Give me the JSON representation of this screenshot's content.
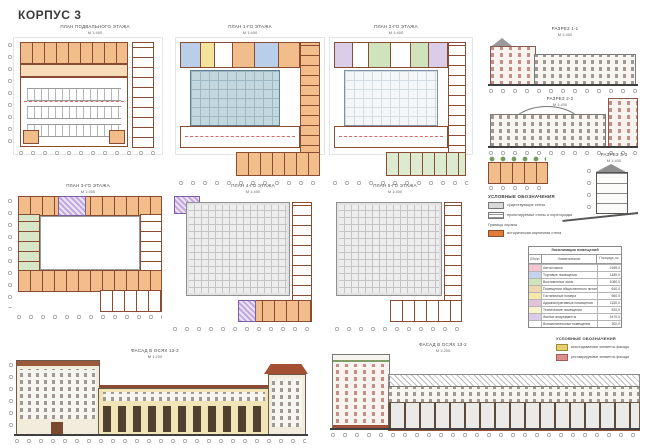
{
  "sheet_title": "КОРПУС 3",
  "plans": [
    {
      "title": "ПЛАН ПОДВАЛЬНОГО ЭТАЖА",
      "scale": "М 1:400"
    },
    {
      "title": "ПЛАН 1-ГО ЭТАЖА",
      "scale": "М 1:400"
    },
    {
      "title": "ПЛАН 2-ГО ЭТАЖА",
      "scale": "М 1:400"
    },
    {
      "title": "ПЛАН 3-ГО ЭТАЖА",
      "scale": "М 1:400"
    },
    {
      "title": "ПЛАН 4-ГО ЭТАЖА",
      "scale": "М 1:400"
    },
    {
      "title": "ПЛАН 5-ГО ЭТАЖА",
      "scale": "М 1:400"
    }
  ],
  "sections": [
    {
      "title": "РАЗРЕЗ 1-1",
      "scale": "М 1:400"
    },
    {
      "title": "РАЗРЕЗ 2-2",
      "scale": "М 1:400"
    },
    {
      "title": "РАЗРЕЗ 3-3",
      "scale": "М 1:400"
    }
  ],
  "facades": [
    {
      "title": "ФАСАД В ОСЯХ 13-2",
      "scale": "М 1:200"
    },
    {
      "title": "ФАСАД В ОСЯХ 13-2",
      "scale": "М 1:200"
    }
  ],
  "legend_sections": {
    "title": "УСЛОВНЫЕ ОБОЗНАЧЕНИЯ",
    "items": [
      {
        "label": "существующие стены"
      },
      {
        "label": "проектируемые стены и перегородки"
      }
    ],
    "subheading": "Границы охраны",
    "highlight_label": "историческая кирпичная стена"
  },
  "legend_facades": {
    "title": "УСЛОВНЫЕ ОБОЗНАЧЕНИЯ",
    "items": [
      {
        "label": "воссоздаваемые элементы фасада"
      },
      {
        "label": "реставрируемые элементы фасада"
      }
    ]
  },
  "room_table": {
    "title": "Экспликация помещений",
    "columns": [
      "Обозн.",
      "Наименование",
      "Площадь, м²"
    ],
    "rows": [
      {
        "color": "#f3c6d0",
        "name": "Автостоянка",
        "area": "2185,0"
      },
      {
        "color": "#c3d4ec",
        "name": "Торговые помещения",
        "area": "1180,0"
      },
      {
        "color": "#cfe3bd",
        "name": "Выставочные залы",
        "area": "1080,0"
      },
      {
        "color": "#f0d7b2",
        "name": "Помещения общественного питания",
        "area": "640,0"
      },
      {
        "color": "#f4e9a9",
        "name": "Гостиничные номера",
        "area": "960,0"
      },
      {
        "color": "#e3c3da",
        "name": "Административные помещения",
        "area": "1150,0"
      },
      {
        "color": "#f8f3cf",
        "name": "Технические помещения",
        "area": "520,0"
      },
      {
        "color": "#d9cdea",
        "name": "Жилые апартаменты",
        "area": "1470,0"
      },
      {
        "color": "#ffffff",
        "name": "Вспомогательные помещения",
        "area": "300,0"
      }
    ]
  },
  "colors": {
    "wall": "#8a4b33",
    "accent_orange": "#e07b39",
    "atrium_blue": "#c3d7de"
  }
}
